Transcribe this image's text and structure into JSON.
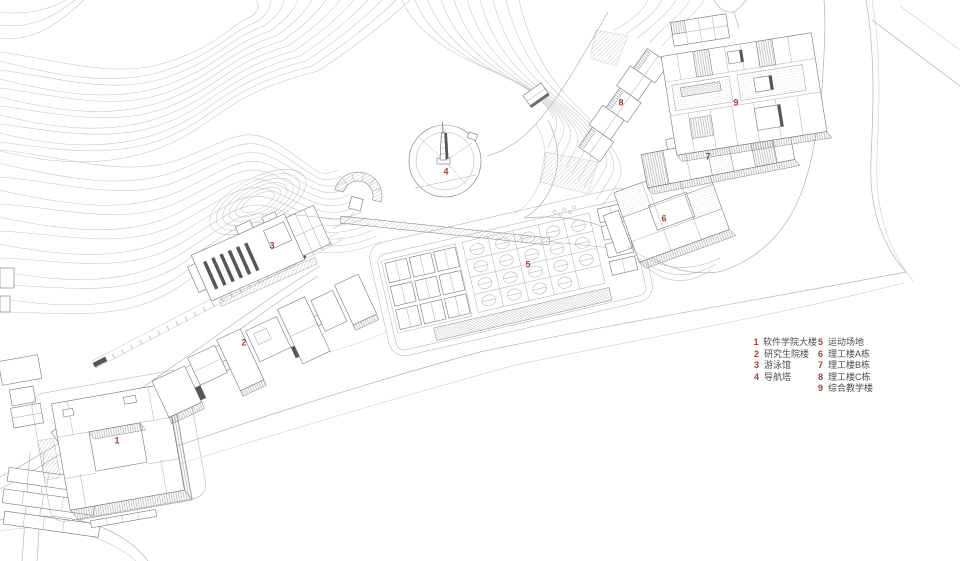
{
  "legend": {
    "items": [
      {
        "num": "1",
        "label": "软件学院大楼"
      },
      {
        "num": "2",
        "label": "研究生院楼"
      },
      {
        "num": "3",
        "label": "游泳馆"
      },
      {
        "num": "4",
        "label": "导航塔"
      },
      {
        "num": "5",
        "label": "运动场地"
      },
      {
        "num": "6",
        "label": "理工楼A栋"
      },
      {
        "num": "7",
        "label": "理工楼B栋"
      },
      {
        "num": "8",
        "label": "理工楼C栋"
      },
      {
        "num": "9",
        "label": "综合教学楼"
      }
    ]
  },
  "map_markers": [
    {
      "num": "1"
    },
    {
      "num": "2"
    },
    {
      "num": "3"
    },
    {
      "num": "4"
    },
    {
      "num": "5"
    },
    {
      "num": "6"
    },
    {
      "num": "7"
    },
    {
      "num": "8"
    },
    {
      "num": "9"
    }
  ],
  "colors": {
    "marker_red": "#a93d37",
    "legend_text": "#4c4c4c",
    "line_gray": "#9aa0a4",
    "background": "#ffffff"
  }
}
